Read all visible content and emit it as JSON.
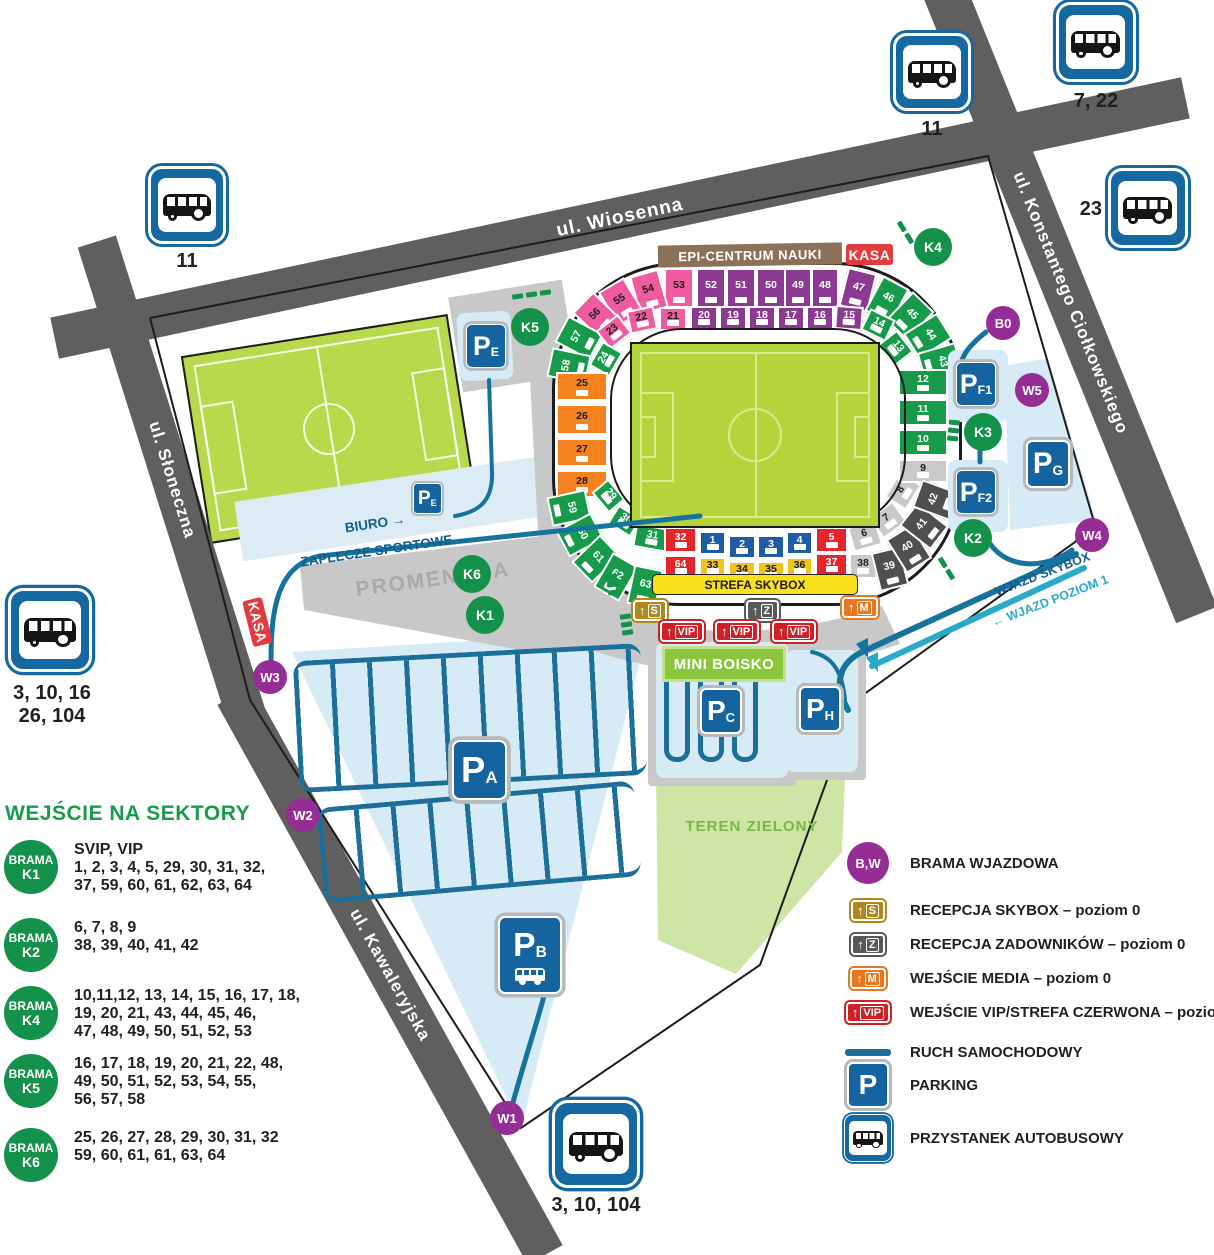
{
  "roads": {
    "wiosenna": "ul. Wiosenna",
    "slonecza": "ul. Słoneczna",
    "kawaleryjska": "ul. Kawaleryjska",
    "ciolkowskiego": "ul. Konstantego Ciołkowskiego"
  },
  "labels": {
    "epi": "EPI-CENTRUM NAUKI",
    "kasa": "KASA",
    "strefa_skybox": "STREFA SKYBOX",
    "mini_boisko": "MINI BOISKO",
    "teren_zielony": "TEREN ZIELONY",
    "boisko_boczne": "BOISKO BOCZNE",
    "promenada": "PROMENADA",
    "biuro": "BIURO  →",
    "zaplecze": "ZAPLECZE SPORTOWE  →",
    "wjazd_skybox": "← WJAZD SKYBOX",
    "wjazd_poziom": "← WJAZD POZIOM 1"
  },
  "gates": {
    "w1": "W1",
    "w2": "W2",
    "w3": "W3",
    "w4": "W4",
    "w5": "W5",
    "b0": "B0",
    "k1": "K1",
    "k2": "K2",
    "k3": "K3",
    "k4": "K4",
    "k5": "K5",
    "k6": "K6"
  },
  "entrances": {
    "s": "S",
    "z": "Z",
    "m": "M",
    "vip": "VIP"
  },
  "parkings": {
    "pa": {
      "p": "P",
      "sub": "A"
    },
    "pb": {
      "p": "P",
      "sub": "B"
    },
    "pc": {
      "p": "P",
      "sub": "C"
    },
    "pe": {
      "p": "P",
      "sub": "E"
    },
    "pf1": {
      "p": "P",
      "sub": "F1"
    },
    "pf2": {
      "p": "P",
      "sub": "F2"
    },
    "pg": {
      "p": "P",
      "sub": "G"
    },
    "ph": {
      "p": "P",
      "sub": "H"
    }
  },
  "bus_stops": {
    "top_left": {
      "line1": "11"
    },
    "top": {
      "line1": "11"
    },
    "top_right": {
      "line1": "7, 22"
    },
    "right": {
      "line1": "23"
    },
    "left": {
      "line1": "3, 10, 16",
      "line2": "26, 104"
    },
    "bottom": {
      "line1": "3, 10, 104"
    }
  },
  "stadium": {
    "sectors": [
      [
        "53",
        112,
        6,
        30,
        40,
        0,
        "P"
      ],
      [
        "54",
        82,
        10,
        30,
        40,
        -16,
        "P"
      ],
      [
        "55",
        54,
        20,
        30,
        40,
        -31,
        "P"
      ],
      [
        "56",
        30,
        34,
        30,
        40,
        -46,
        "P"
      ],
      [
        "57",
        12,
        56,
        30,
        40,
        -62,
        "G"
      ],
      [
        "58",
        2,
        84,
        30,
        40,
        -78,
        "G"
      ],
      [
        "52",
        144,
        6,
        30,
        40,
        0,
        "V"
      ],
      [
        "51",
        174,
        6,
        30,
        40,
        0,
        "V"
      ],
      [
        "50",
        204,
        6,
        30,
        40,
        0,
        "V"
      ],
      [
        "49",
        232,
        6,
        28,
        40,
        0,
        "V"
      ],
      [
        "48",
        259,
        6,
        28,
        40,
        0,
        "V"
      ],
      [
        "47",
        291,
        8,
        30,
        40,
        14,
        "V"
      ],
      [
        "46",
        320,
        18,
        30,
        40,
        28,
        "G"
      ],
      [
        "45",
        343,
        34,
        30,
        40,
        44,
        "G"
      ],
      [
        "44",
        361,
        54,
        30,
        40,
        58,
        "G"
      ],
      [
        "43",
        373,
        80,
        30,
        40,
        74,
        "G"
      ],
      [
        "23",
        48,
        58,
        28,
        24,
        -38,
        "P"
      ],
      [
        "22",
        76,
        46,
        28,
        24,
        -12,
        "P"
      ],
      [
        "21",
        107,
        45,
        28,
        24,
        0,
        "P"
      ],
      [
        "20",
        138,
        44,
        28,
        24,
        0,
        "V"
      ],
      [
        "19",
        167,
        44,
        28,
        24,
        0,
        "V"
      ],
      [
        "18",
        196,
        44,
        28,
        24,
        0,
        "V"
      ],
      [
        "17",
        225,
        44,
        28,
        24,
        0,
        "V"
      ],
      [
        "16",
        254,
        44,
        28,
        24,
        0,
        "V"
      ],
      [
        "15",
        283,
        44,
        28,
        24,
        4,
        "V"
      ],
      [
        "14",
        312,
        51,
        28,
        24,
        26,
        "G"
      ],
      [
        "13",
        330,
        74,
        28,
        24,
        52,
        "G"
      ],
      [
        "24",
        40,
        85,
        28,
        24,
        -60,
        "G"
      ],
      [
        "25",
        4,
        110,
        52,
        29,
        0,
        "O"
      ],
      [
        "26",
        4,
        142,
        52,
        31,
        0,
        "O"
      ],
      [
        "27",
        4,
        176,
        52,
        29,
        0,
        "O"
      ],
      [
        "28",
        4,
        208,
        52,
        28,
        0,
        "O"
      ],
      [
        "59",
        2,
        226,
        30,
        40,
        78,
        "G"
      ],
      [
        "60",
        13,
        253,
        30,
        40,
        62,
        "G"
      ],
      [
        "61",
        29,
        277,
        30,
        40,
        46,
        "G"
      ],
      [
        "62",
        49,
        295,
        30,
        40,
        30,
        "G"
      ],
      [
        "63",
        78,
        305,
        30,
        40,
        12,
        "G"
      ],
      [
        "29",
        43,
        223,
        27,
        22,
        50,
        "G"
      ],
      [
        "30",
        59,
        248,
        27,
        22,
        32,
        "G"
      ],
      [
        "31",
        82,
        264,
        36,
        24,
        10,
        "G"
      ],
      [
        "32",
        112,
        265,
        33,
        26,
        0,
        "R"
      ],
      [
        "1",
        147,
        269,
        27,
        24,
        0,
        "B"
      ],
      [
        "2",
        176,
        273,
        28,
        24,
        0,
        "B"
      ],
      [
        "3",
        205,
        273,
        28,
        24,
        0,
        "B"
      ],
      [
        "4",
        234,
        269,
        27,
        24,
        0,
        "B"
      ],
      [
        "5",
        263,
        265,
        33,
        26,
        0,
        "R"
      ],
      [
        "64",
        112,
        293,
        33,
        24,
        0,
        "R"
      ],
      [
        "33",
        147,
        295,
        27,
        22,
        0,
        "Y"
      ],
      [
        "34",
        176,
        299,
        28,
        22,
        0,
        "Y"
      ],
      [
        "35",
        205,
        299,
        28,
        22,
        0,
        "Y"
      ],
      [
        "36",
        234,
        295,
        27,
        22,
        0,
        "Y"
      ],
      [
        "37",
        263,
        291,
        33,
        24,
        0,
        "R"
      ],
      [
        "6",
        298,
        261,
        30,
        26,
        -16,
        "L"
      ],
      [
        "7",
        321,
        245,
        30,
        26,
        -36,
        "L"
      ],
      [
        "8",
        336,
        216,
        30,
        26,
        -58,
        "L"
      ],
      [
        "38",
        297,
        291,
        28,
        26,
        0,
        "L"
      ],
      [
        "9",
        346,
        197,
        50,
        24,
        0,
        "L"
      ],
      [
        "39",
        323,
        287,
        30,
        40,
        -14,
        "D"
      ],
      [
        "40",
        342,
        267,
        30,
        40,
        -32,
        "D"
      ],
      [
        "41",
        357,
        244,
        30,
        40,
        -52,
        "D"
      ],
      [
        "42",
        369,
        218,
        30,
        40,
        -70,
        "D"
      ],
      [
        "10",
        346,
        167,
        50,
        27,
        0,
        "G"
      ],
      [
        "11",
        346,
        137,
        50,
        27,
        0,
        "G"
      ],
      [
        "12",
        346,
        107,
        50,
        27,
        0,
        "G"
      ]
    ]
  },
  "legend_left": {
    "title": "WEJŚCIE NA SEKTORY",
    "entries": [
      {
        "circle_top": "BRAMA",
        "circle_id": "K1",
        "lines": [
          "SVIP, VIP",
          "1, 2, 3, 4, 5, 29, 30, 31, 32,",
          "37, 59, 60, 61, 62, 63, 64"
        ]
      },
      {
        "circle_top": "BRAMA",
        "circle_id": "K2",
        "lines": [
          "6, 7, 8, 9",
          "38, 39, 40, 41, 42"
        ]
      },
      {
        "circle_top": "BRAMA",
        "circle_id": "K4",
        "lines": [
          "10,11,12, 13, 14, 15, 16, 17, 18,",
          "19, 20, 21, 43, 44, 45, 46,",
          "47, 48, 49, 50, 51, 52, 53"
        ]
      },
      {
        "circle_top": "BRAMA",
        "circle_id": "K5",
        "lines": [
          "16, 17, 18, 19, 20, 21, 22, 48,",
          "49, 50, 51, 52, 53, 54, 55,",
          "56, 57, 58"
        ]
      },
      {
        "circle_top": "BRAMA",
        "circle_id": "K6",
        "lines": [
          "25, 26, 27, 28, 29, 30, 31, 32",
          "59, 60, 61, 61, 63, 64"
        ]
      }
    ]
  },
  "legend_right": {
    "entries": [
      {
        "type": "circle-bw",
        "glyph": "B,W",
        "label": "BRAMA WJAZDOWA"
      },
      {
        "type": "gate-s",
        "glyph": "S",
        "label": "RECEPCJA SKYBOX – poziom 0"
      },
      {
        "type": "gate-z",
        "glyph": "Z",
        "label": "RECEPCJA ZADOWNIKÓW – poziom 0"
      },
      {
        "type": "gate-m",
        "glyph": "M",
        "label": "WEJŚCIE MEDIA – poziom 0"
      },
      {
        "type": "gate-vip",
        "glyph": "VIP",
        "label": "WEJŚCIE VIP/STREFA CZERWONA – poziom 1"
      },
      {
        "type": "line",
        "label": "RUCH SAMOCHODOWY"
      },
      {
        "type": "parking",
        "glyph": "P",
        "label": "PARKING"
      },
      {
        "type": "bus",
        "label": "PRZYSTANEK AUTOBUSOWY"
      }
    ]
  },
  "colors": {
    "pink": "#ee5ba0",
    "purple": "#8a3b91",
    "green": "#179b4b",
    "orange": "#f5821f",
    "red": "#e5252a",
    "blue": "#1e5ca6",
    "yellow": "#efc31a",
    "lightgray": "#c9c9c9",
    "darkgray": "#4f4f4f",
    "route": "#16739e",
    "route_light": "#2ba9c9",
    "road": "#5f5f5f",
    "sign_blue": "#15639f",
    "circle_purple": "#942d94",
    "circle_green": "#14914a",
    "kasa_red": "#e23b3f",
    "skybox_yellow": "#f9e01d"
  }
}
